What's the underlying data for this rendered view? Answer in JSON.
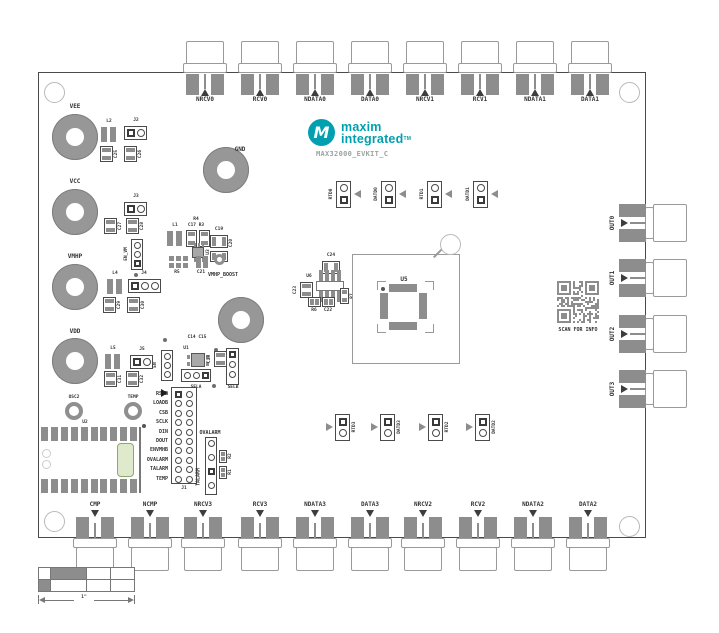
{
  "logo": {
    "mark_letter": "M",
    "brand_top": "maxim",
    "brand_bottom": "integrated",
    "trademark": "TM",
    "part_number": "MAX32000_EVKIT_C"
  },
  "connectors": {
    "top": [
      "NRCV0",
      "RCV0",
      "NDATA0",
      "DATA0",
      "NRCV1",
      "RCV1",
      "NDATA1",
      "DATA1"
    ],
    "bottom": [
      "CMP",
      "NCMP",
      "NRCV3",
      "RCV3",
      "NDATA3",
      "DATA3",
      "NRCV2",
      "RCV2",
      "NDATA2",
      "DATA2"
    ],
    "right": [
      "OUT0",
      "OUT1",
      "OUT2",
      "OUT3"
    ]
  },
  "power_terminals": [
    "VEE",
    "VCC",
    "VMHP",
    "VDD",
    "GND"
  ],
  "jumpers": {
    "top": [
      "RTD0",
      "DATD0",
      "RTD1",
      "DATD1"
    ],
    "bottom": [
      "RTD3",
      "DATD3",
      "RTD2",
      "DATD2"
    ]
  },
  "j1": {
    "designator": "J1",
    "pins": [
      "RSTB",
      "LOADB",
      "CSB",
      "SCLK",
      "DIN",
      "DOUT",
      "ENVMHB",
      "OVALARM",
      "TALARM",
      "TEMP"
    ]
  },
  "sel_header": {
    "caps": "C14 C15",
    "c13": "C13",
    "u1": "U1",
    "en": "EN",
    "sela": "SELA",
    "selb": "SELB"
  },
  "alarm_header": {
    "ovalarm": "OVALARM",
    "talarm": "TALARM",
    "r2": "R2",
    "r1": "R1"
  },
  "vee_parts": {
    "l2": "L2",
    "j2": "J2",
    "c25": "C25",
    "c26": "C26"
  },
  "vcc_parts": {
    "j3": "J3",
    "c27": "C27",
    "c28": "C28"
  },
  "vmhp_parts": {
    "en": "EN_VM",
    "l4": "L4",
    "j4": "J4",
    "c29": "C29",
    "c30": "C30"
  },
  "vdd_parts": {
    "l5": "L5",
    "j5": "J5",
    "c31": "C31",
    "c32": "C32"
  },
  "boost": {
    "l1": "L1",
    "r4": "R4",
    "c17r3": "C17 R3",
    "c19": "C19",
    "c20": "C20",
    "u3": "U3",
    "r5": "R5",
    "c21": "C21",
    "name": "VMHP_BOOST"
  },
  "center_parts": {
    "c24": "C24",
    "u6": "U6",
    "c23": "C23",
    "r6": "R6",
    "c22": "C22",
    "r7": "R7",
    "u5": "U5"
  },
  "misc": {
    "u2": "U2",
    "osc2": "OSC2",
    "temp": "TEMP"
  },
  "qr": {
    "caption": "SCAN FOR INFO"
  },
  "scale": {
    "dimension": "1\""
  },
  "colors": {
    "teal": "#00a0b0",
    "silkscreen": "#333333",
    "pad_gray": "#8d8d8d",
    "outline_gray": "#9a9a9a"
  }
}
